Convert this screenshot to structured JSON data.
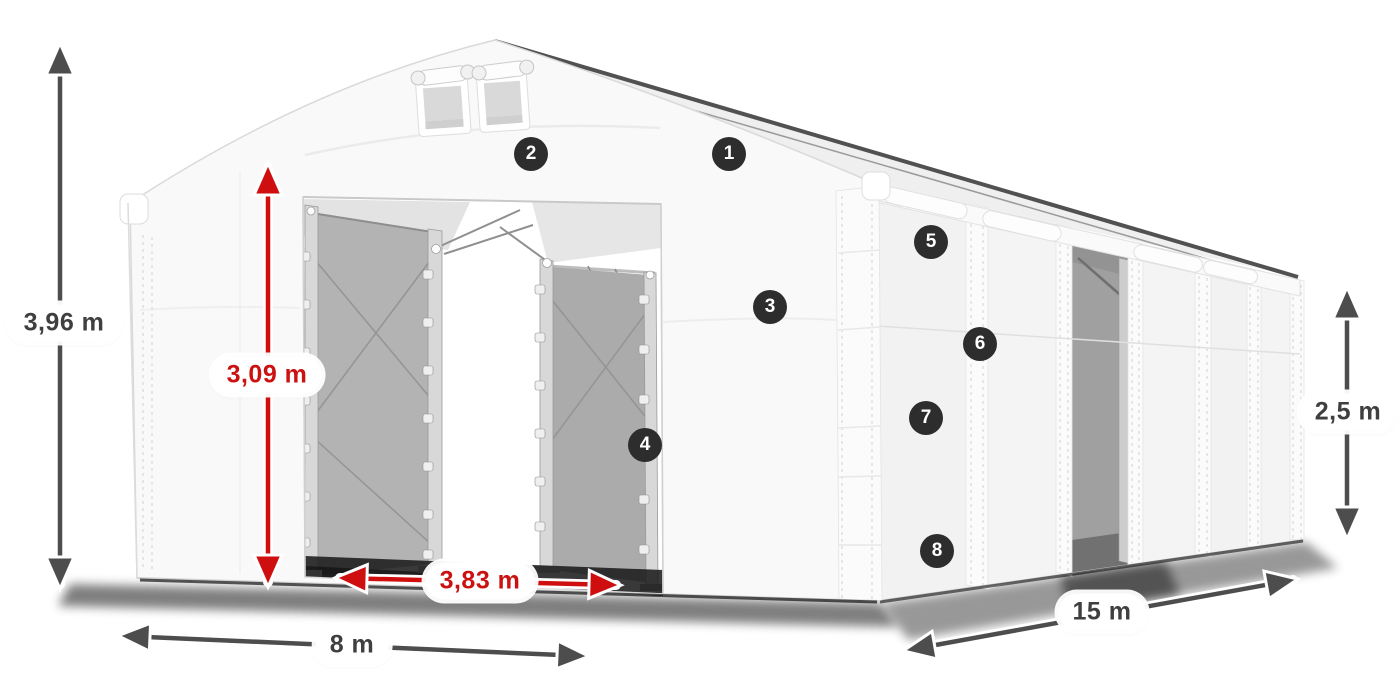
{
  "colors": {
    "arrow_dark": "#4d4d4d",
    "arrow_red": "#cf0f0f",
    "label_bg": "#ffffff",
    "label_text_dark": "#3f3f3f",
    "label_text_red": "#cc1111",
    "callout_bg": "#2d2d2d",
    "callout_text": "#ffffff"
  },
  "diagram": {
    "subject": "white gabled storage tent shown in perspective with dimension arrows and numbered feature markers",
    "measurements": {
      "total_height": {
        "text": "3,96 m",
        "color": "dark"
      },
      "door_height": {
        "text": "3,09 m",
        "color": "red"
      },
      "door_width": {
        "text": "3,83 m",
        "color": "red"
      },
      "front_width": {
        "text": "8 m",
        "color": "dark"
      },
      "side_length": {
        "text": "15 m",
        "color": "dark"
      },
      "side_height": {
        "text": "2,5 m",
        "color": "dark"
      }
    },
    "callouts": [
      {
        "number": "1"
      },
      {
        "number": "2"
      },
      {
        "number": "3"
      },
      {
        "number": "4"
      },
      {
        "number": "5"
      },
      {
        "number": "6"
      },
      {
        "number": "7"
      },
      {
        "number": "8"
      }
    ]
  }
}
